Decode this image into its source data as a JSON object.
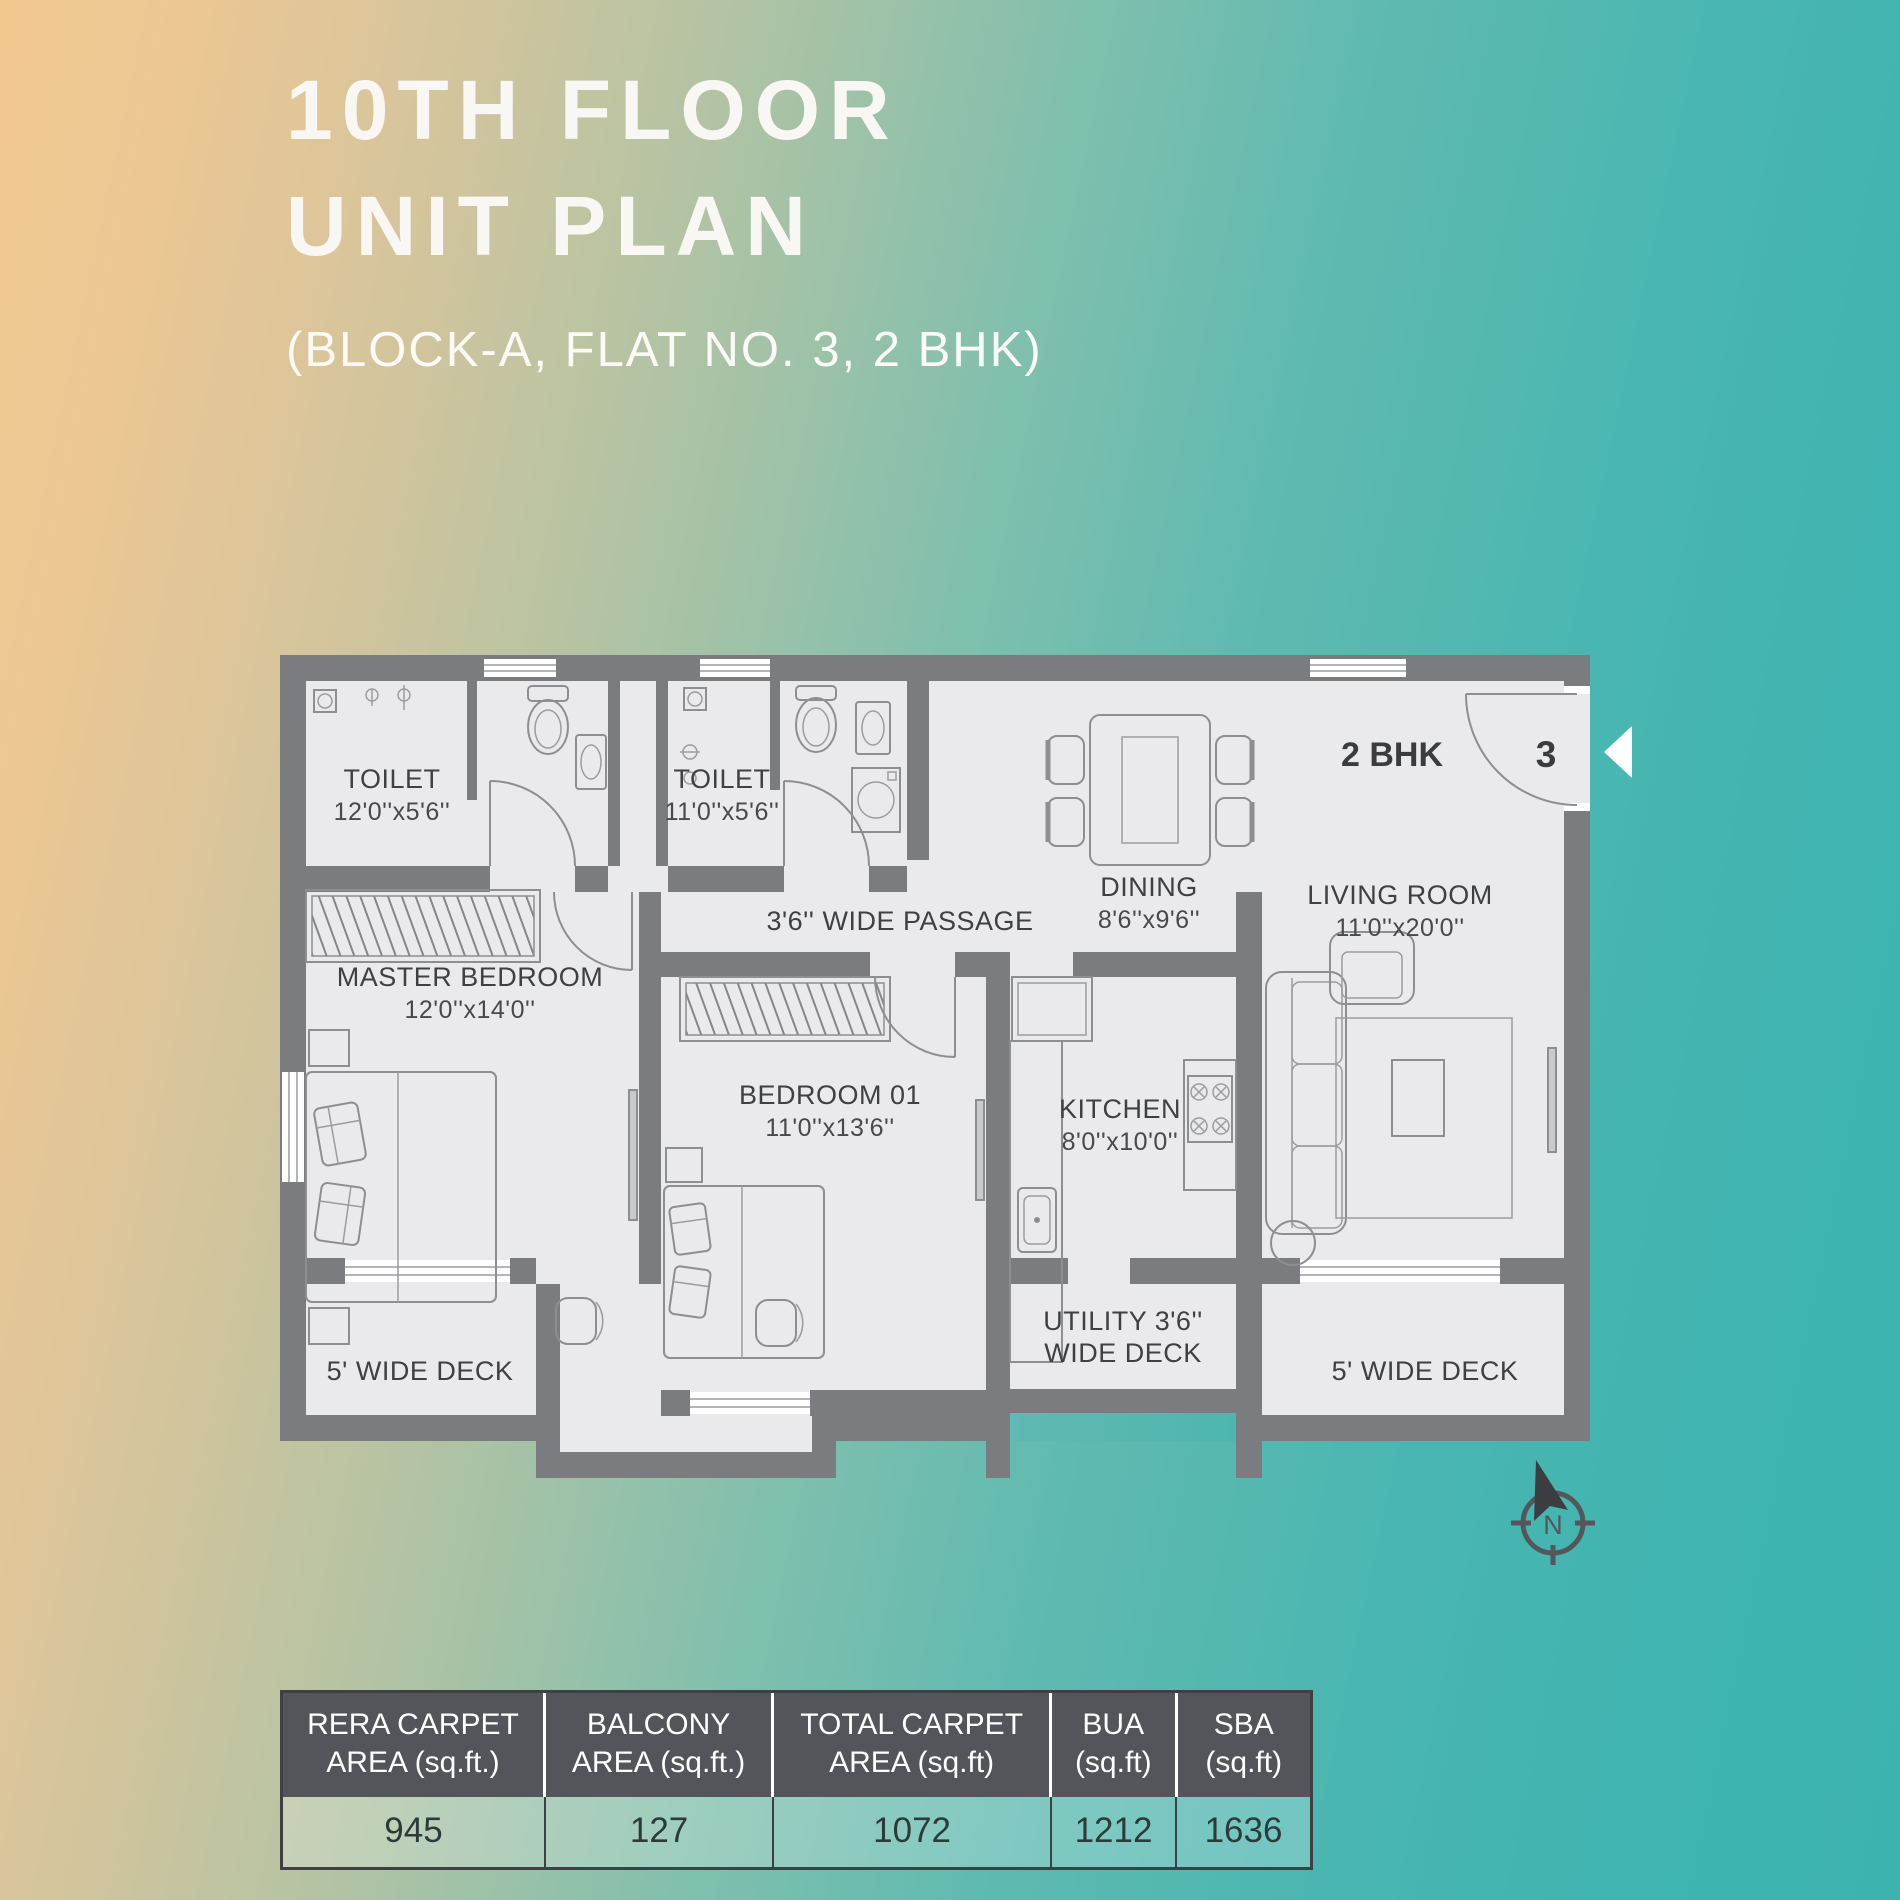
{
  "title": {
    "line1": "10TH FLOOR",
    "line2": "UNIT PLAN",
    "subtitle": "(BLOCK-A, FLAT NO. 3, 2 BHK)"
  },
  "plan": {
    "unit_type_label": "2 BHK",
    "flat_number": "3",
    "compass_label": "N",
    "rooms": {
      "toilet_master": {
        "name": "TOILET",
        "dims": "12'0''x5'6''"
      },
      "toilet_common": {
        "name": "TOILET",
        "dims": "11'0''x5'6''"
      },
      "passage": {
        "name": "3'6'' WIDE PASSAGE"
      },
      "dining": {
        "name": "DINING",
        "dims": "8'6''x9'6''"
      },
      "living_room": {
        "name": "LIVING ROOM",
        "dims": "11'0''x20'0''"
      },
      "master_bedroom": {
        "name": "MASTER BEDROOM",
        "dims": "12'0''x14'0''"
      },
      "bedroom_01": {
        "name": "BEDROOM 01",
        "dims": "11'0''x13'6''"
      },
      "kitchen": {
        "name": "KITCHEN",
        "dims": "8'0''x10'0''"
      },
      "deck_left": {
        "name": "5' WIDE DECK"
      },
      "deck_right": {
        "name": "5' WIDE DECK"
      },
      "utility_deck": {
        "line1": "UTILITY 3'6''",
        "line2": "WIDE DECK"
      }
    }
  },
  "areas_table": {
    "columns": [
      {
        "h1": "RERA CARPET",
        "h2": "AREA (sq.ft.)",
        "value": "945"
      },
      {
        "h1": "BALCONY",
        "h2": "AREA (sq.ft.)",
        "value": "127"
      },
      {
        "h1": "TOTAL CARPET",
        "h2": "AREA (sq.ft)",
        "value": "1072"
      },
      {
        "h1": "BUA",
        "h2": "(sq.ft)",
        "value": "1212"
      },
      {
        "h1": "SBA",
        "h2": "(sq.ft)",
        "value": "1636"
      }
    ]
  },
  "colors": {
    "gradient_left": "#f3c88f",
    "gradient_right": "#3db3af",
    "wall": "#7b7c80",
    "floor": "#eaeaec",
    "label_text": "#3f4042",
    "table_header_bg": "#54555a",
    "title_text": "#f8f7f3"
  }
}
